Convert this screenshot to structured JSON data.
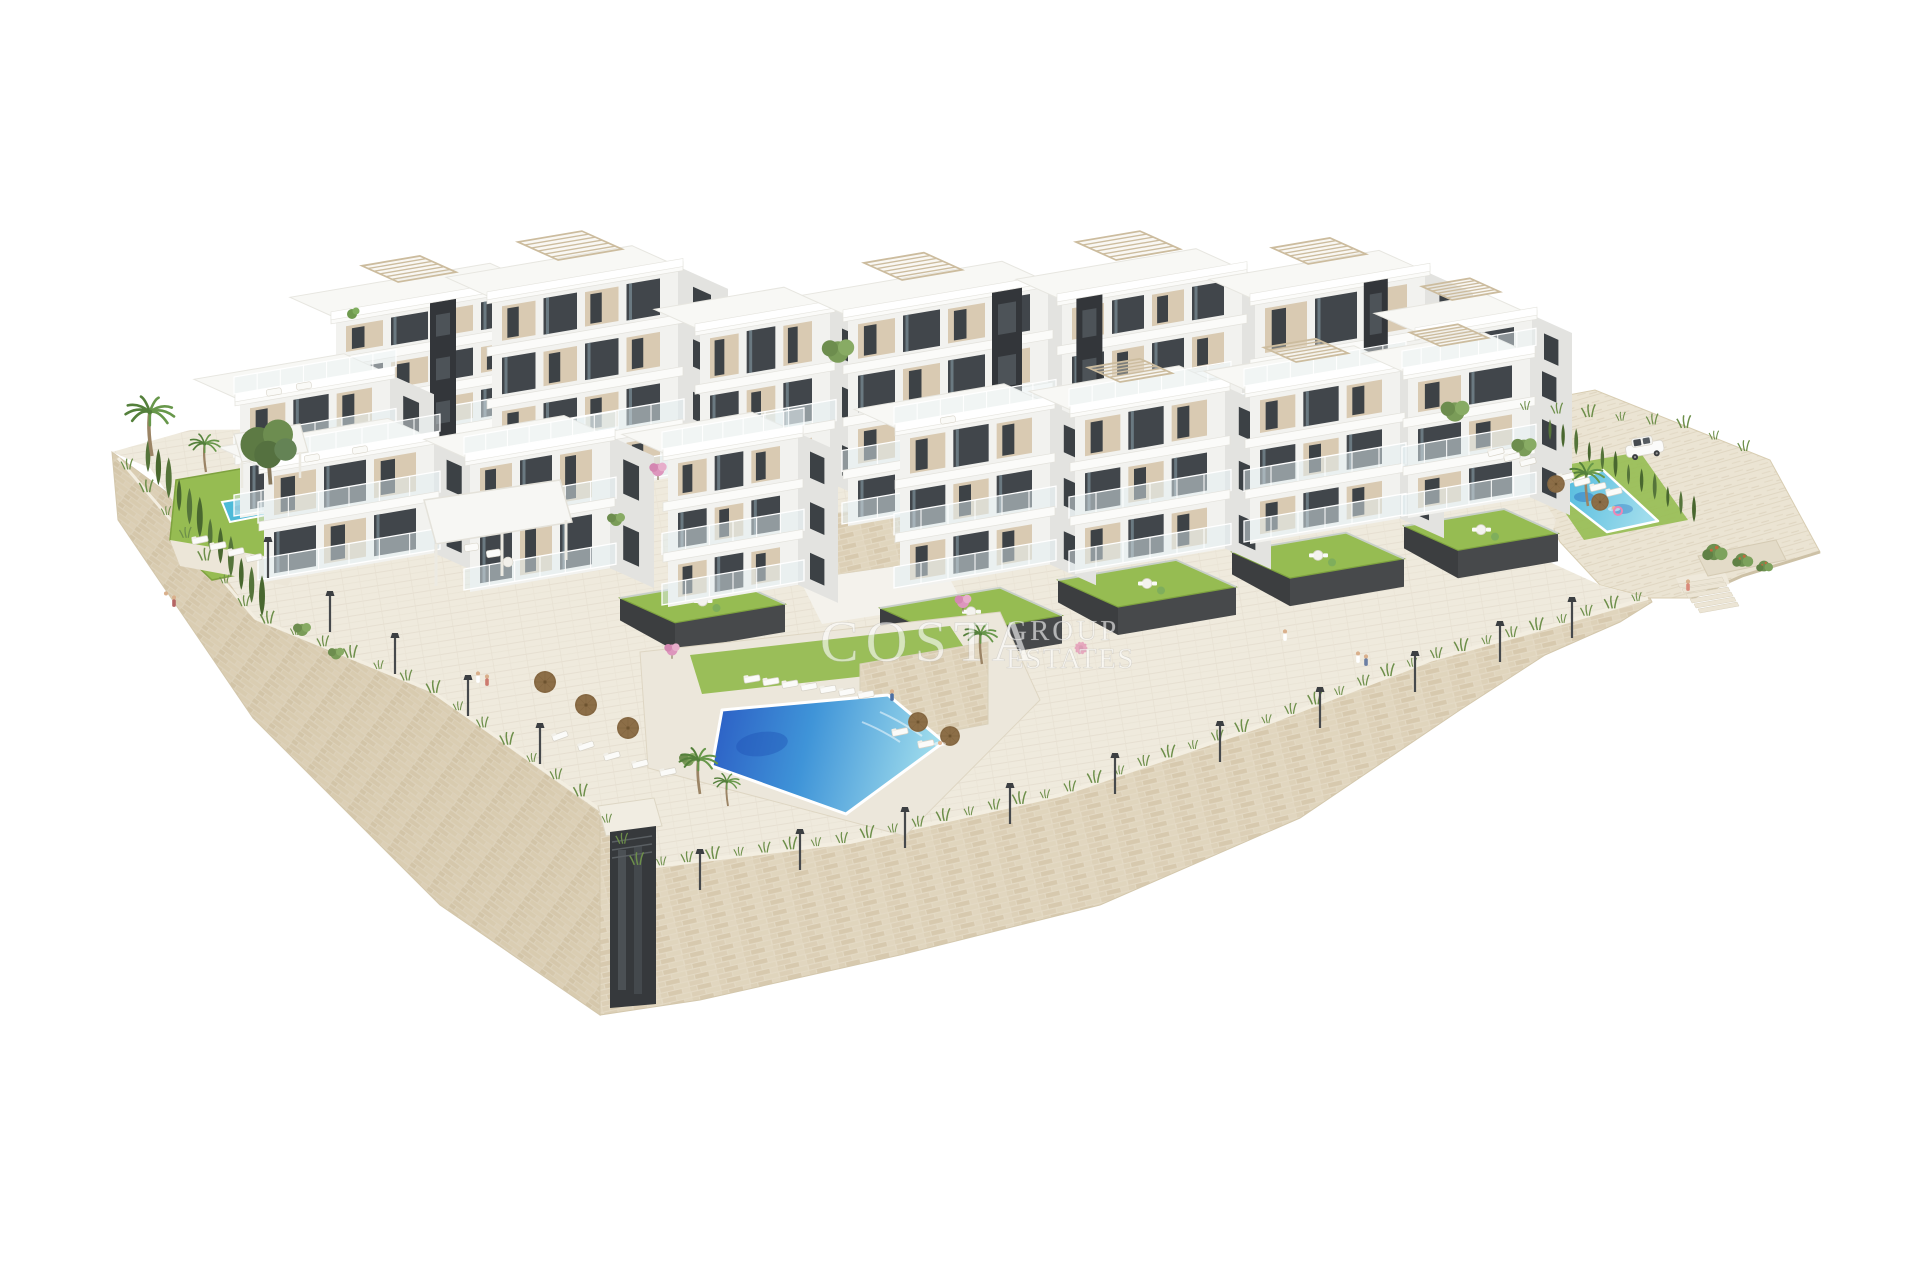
{
  "watermark": {
    "primary": "COSTA",
    "secondary_line1": "GROUP",
    "secondary_line2": "ESTATES",
    "color": "#ffffff",
    "accent_color": "#e06ba3"
  },
  "palette": {
    "background": "#ffffff",
    "stone": "#e4dac5",
    "stone_shaded": "#ddd2bb",
    "paving": "#efeadd",
    "hillside": "#ebe4d3",
    "lawn": "#96bc52",
    "lawn_edge": "#7ea23f",
    "pool_deep": "#2b5cc4",
    "pool_mid": "#3f94d8",
    "pool_light": "#9fdcec",
    "pool_secondary": "#49b7dc",
    "facade_white": "#f2f2ef",
    "facade_shade": "#e3e3e0",
    "panel_beige": "#d9cab2",
    "window_dark": "#3d4246",
    "charcoal": "#34373b",
    "hedge_green": "#55743a",
    "palm_green": "#5d8a44",
    "garden_wall": "#47494b"
  }
}
